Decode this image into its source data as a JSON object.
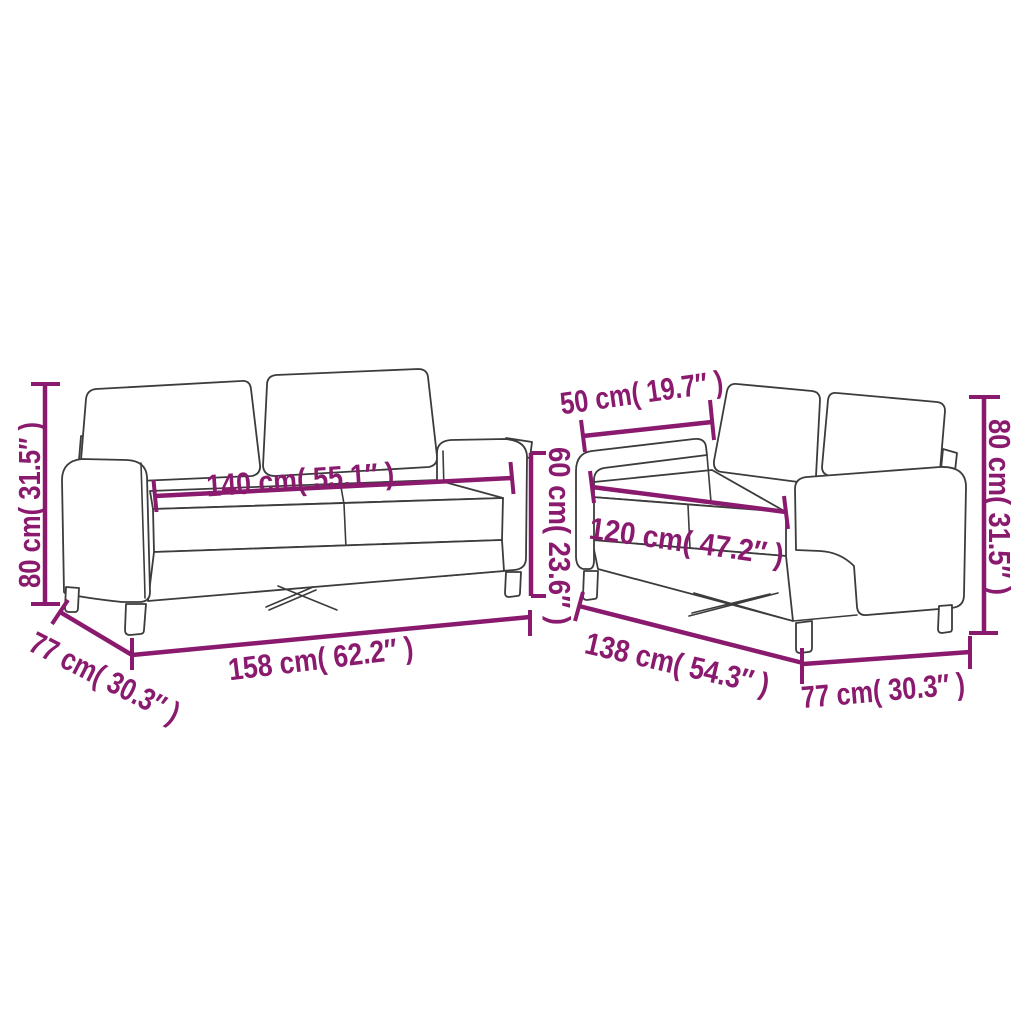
{
  "diagram": {
    "background_color": "#ffffff",
    "accent_color": "#8A1A6E",
    "outline_color": "#3C3C3C",
    "left_sofa": {
      "height": "80 cm( 31.5″ )",
      "seat_width": "140 cm( 55.1″ )",
      "back_height": "60 cm( 23.6″ )",
      "depth": "77 cm( 30.3″ )",
      "width": "158 cm( 62.2″ )"
    },
    "right_sofa": {
      "seat_depth": "50 cm( 19.7″ )",
      "seat_width": "120 cm( 47.2″ )",
      "height": "80 cm( 31.5″ )",
      "width": "138 cm( 54.3″ )",
      "depth": "77 cm( 30.3″ )"
    }
  }
}
